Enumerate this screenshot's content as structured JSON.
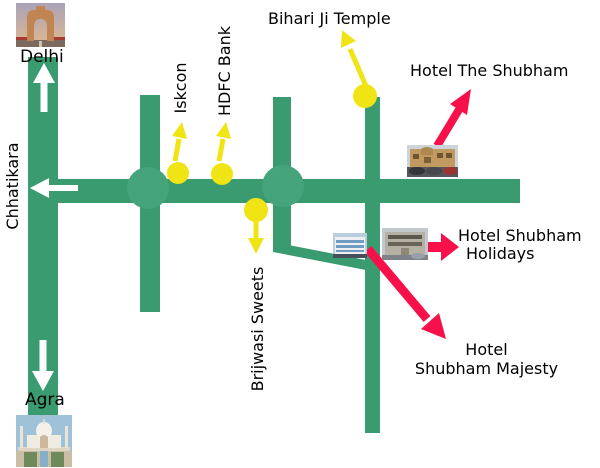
{
  "colors": {
    "background": "#FFFFFF",
    "road_green": "#3A9B70",
    "roundabout_green": "#46A47D",
    "marker_yellow": "#F0E414",
    "arrow_red": "#F8104A",
    "arrow_white": "#FFFFFF",
    "label_text": "#000000"
  },
  "cities": {
    "delhi": {
      "label": "Delhi",
      "photo": "india-gate-photo",
      "sign": "white-arrow-up"
    },
    "agra": {
      "label": "Agra",
      "photo": "taj-mahal-photo",
      "sign": "white-arrow-down"
    },
    "chhatikara": {
      "label": "Chhatikara",
      "sign": "white-arrow-left"
    }
  },
  "landmarks": {
    "iskcon": {
      "label": "Iskcon",
      "marker": "yellow-circle",
      "pointer": "yellow-arrow-up"
    },
    "hdfc_bank": {
      "label": "HDFC Bank",
      "marker": "yellow-circle",
      "pointer": "yellow-arrow-up"
    },
    "bihari_ji_temple": {
      "label": "Bihari Ji Temple",
      "marker": "yellow-circle",
      "pointer": "yellow-arrow-up-left"
    },
    "brijwasi_sweets": {
      "label": "Brijwasi Sweets",
      "marker": "yellow-circle",
      "pointer": "yellow-arrow-down"
    }
  },
  "hotels": {
    "the_shubham": {
      "name": "Hotel The Shubham",
      "photo": "hotel-the-shubham-photo",
      "pointer": "red-arrow-up-right"
    },
    "shubham_holidays": {
      "name_line1": "Hotel Shubham",
      "name_line2": "Holidays",
      "photo": "hotel-shubham-holidays-photo",
      "pointer": "red-arrow-right"
    },
    "shubham_majesty": {
      "name_line1": "Hotel",
      "name_line2": "Shubham Majesty",
      "pointer": "red-arrow-down-right"
    }
  }
}
